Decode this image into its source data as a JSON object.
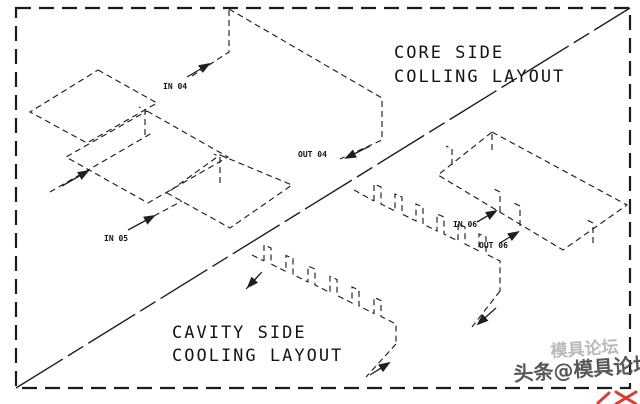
{
  "drawing": {
    "titles": {
      "core": {
        "line1": "CORE SIDE",
        "line2": "COLLING LAYOUT"
      },
      "cavity": {
        "line1": "CAVITY SIDE",
        "line2": "COOLING LAYOUT"
      }
    },
    "port_labels": {
      "in04": "IN 04",
      "out04": "OUT 04",
      "in05": "IN 05",
      "in06": "IN 06",
      "out06": "OUT 06"
    },
    "colors": {
      "line": "#1f1f1f",
      "background": "#ffffff",
      "watermark_faint": "#a8a8a8",
      "watermark_main": "#4f4f4f",
      "stamp_red": "#e03a2f"
    }
  },
  "watermarks": {
    "faint": "模具论坛",
    "main": "头条@模具论坛"
  }
}
